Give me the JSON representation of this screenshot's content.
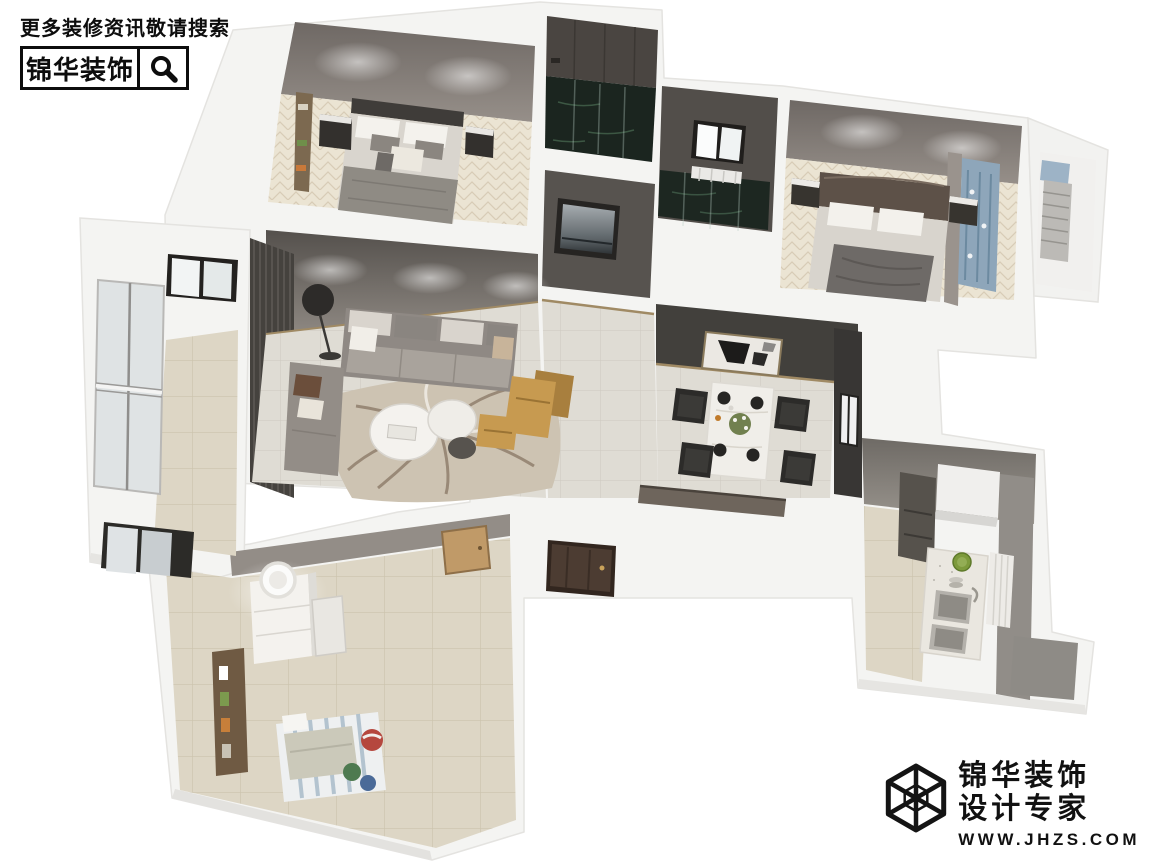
{
  "header": {
    "tagline": "更多装修资讯敬请搜索",
    "brand": "锦华装饰",
    "search_icon": "magnifier-icon"
  },
  "footer": {
    "brand": "锦华装饰",
    "subtitle": "设计专家",
    "website": "WWW.JHZS.COM",
    "logo_icon": "wireframe-cube-icon"
  },
  "colors": {
    "brand_black": "#0d0d0d",
    "page_background": "#ffffff",
    "outer_walls": "#f4f4f2",
    "taupe_wall": "#8b8580",
    "dark_feature_wall": "#45423e",
    "herringbone_wood_floor": "#ebe4d3",
    "tile_floor": "#e1ded7",
    "dark_marble_bath": "#1b251f",
    "leather_lounge_chair": "#c79a50",
    "blue_curtain": "#8ea6ba"
  }
}
